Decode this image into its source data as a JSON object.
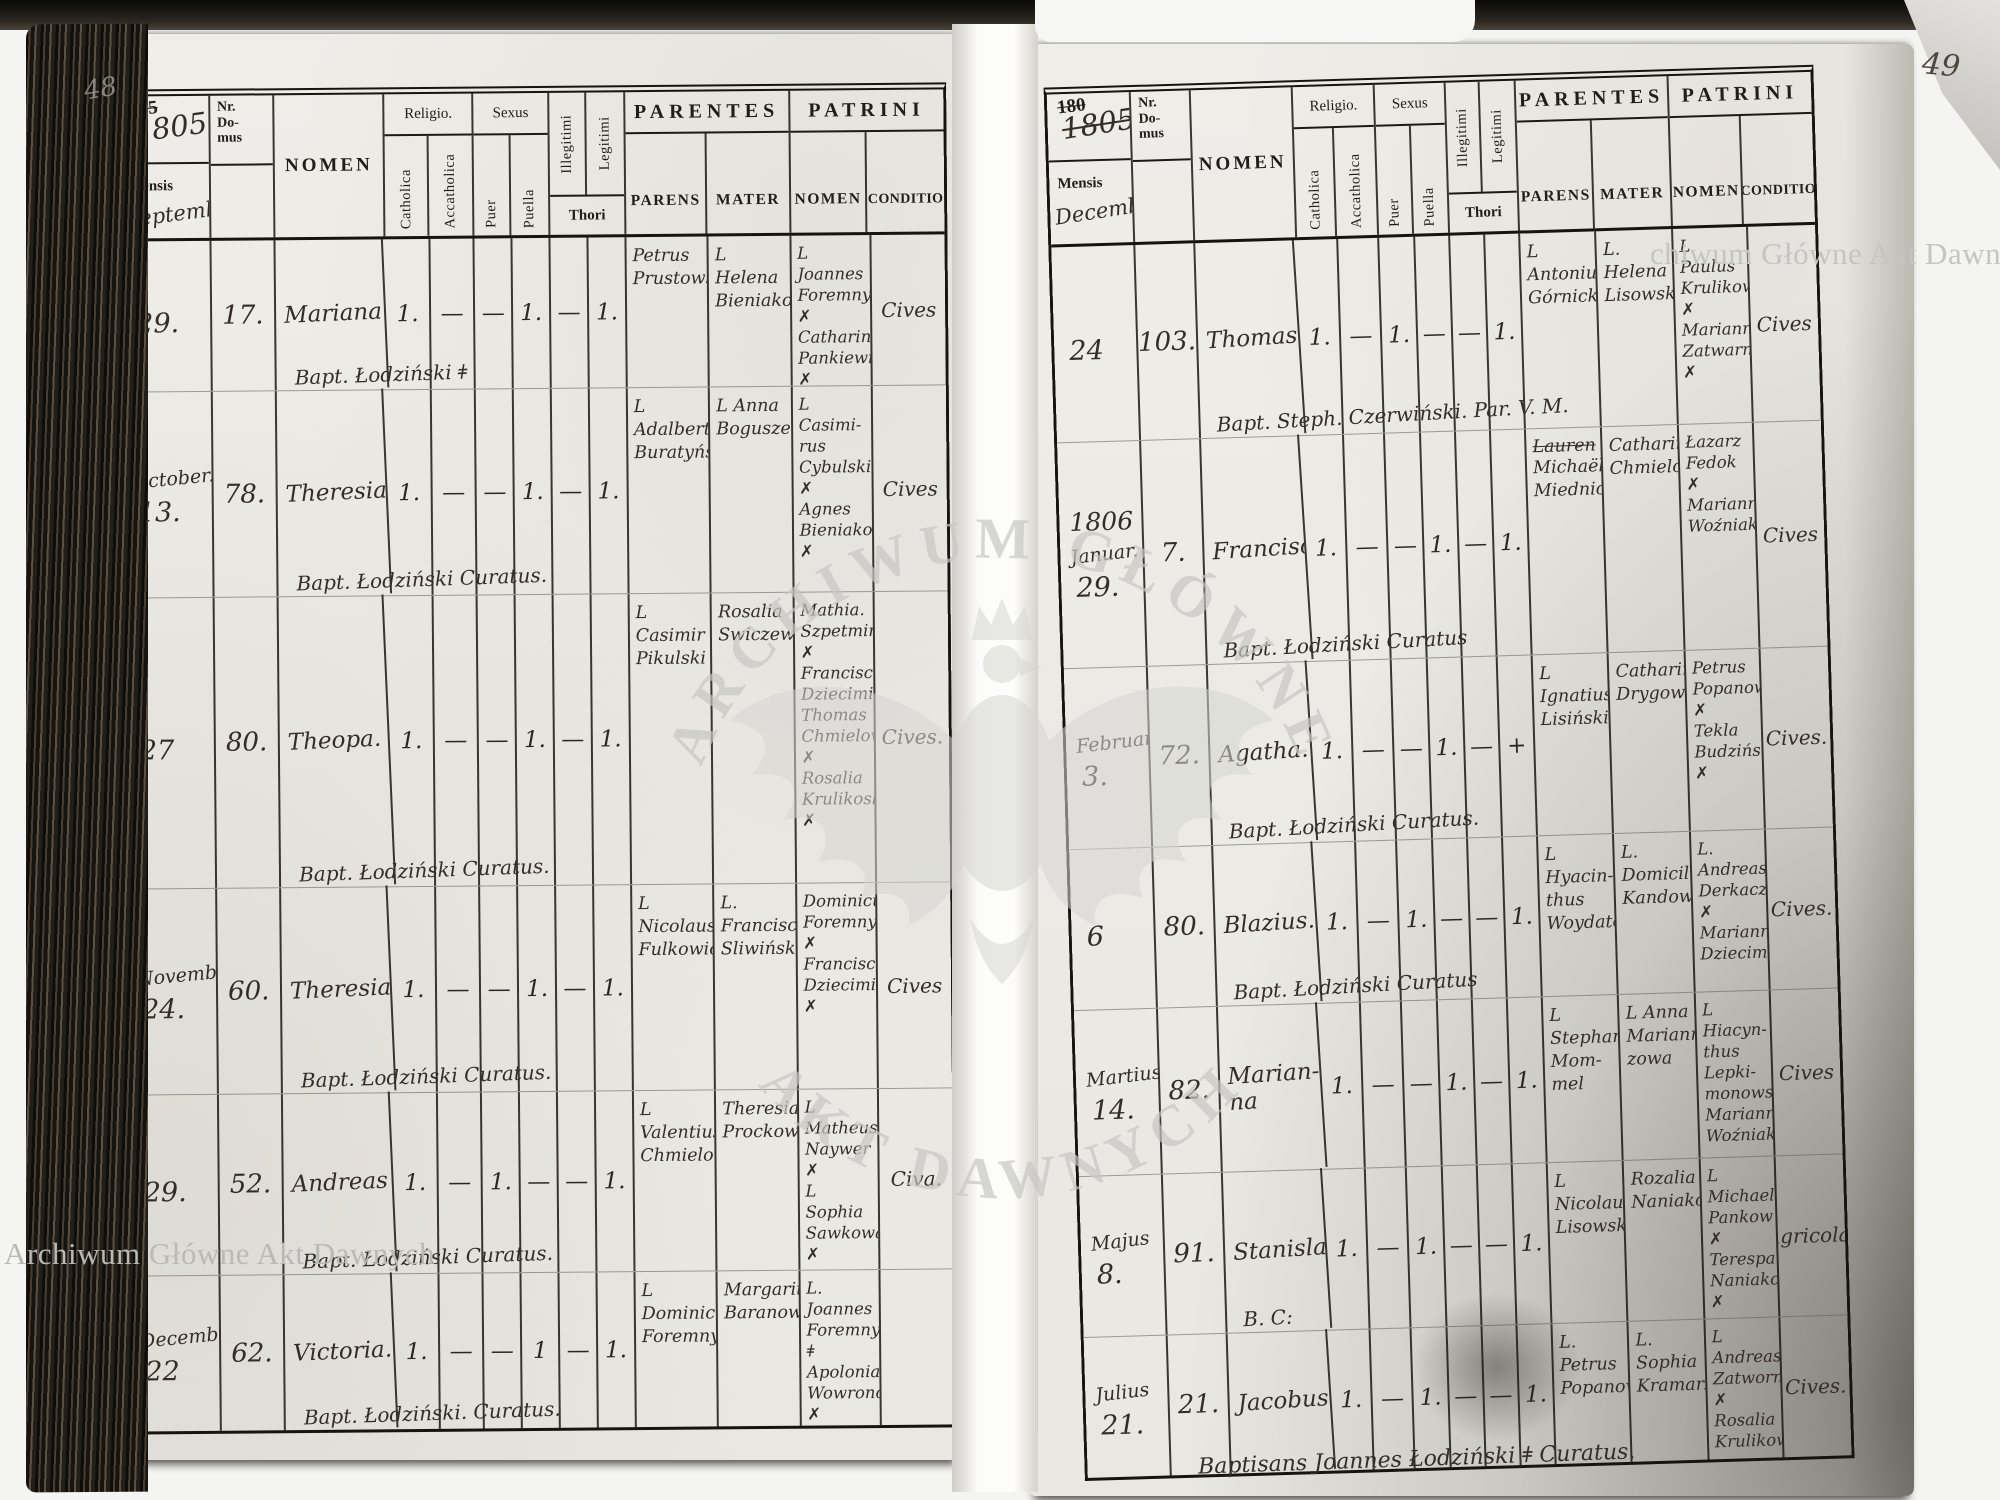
{
  "watermarks": {
    "top_right_text": "chiwum Główne Akt Dawnych",
    "bottom_left_text": "Archiwum Główne Akt Dawnych",
    "seal_top_text": "ARCHIWUM GŁÓWNE",
    "seal_bottom_text": "AKT DAWNYCH"
  },
  "headers": {
    "mensis": "Mensis",
    "nr_domus": "Nr.\nDo-\nmus",
    "nomen": "NOMEN",
    "religio": "Religio.",
    "catholica": "Catholica",
    "acatholica": "Accatholica",
    "sexus": "Sexus",
    "puer": "Puer",
    "puella": "Puella",
    "illegitimi": "Illegitimi",
    "legitimi": "Legitimi",
    "thori": "Thori",
    "parentes": "PARENTES",
    "parens": "PARENS",
    "mater": "MATER",
    "patrini": "PATRINI",
    "patrini_nomen": "NOMEN",
    "conditio": "CONDITIO"
  },
  "left_page": {
    "page_number": "48",
    "year_printed": "175",
    "year_hand": "1805",
    "month_hand": "Septemb:",
    "rows": [
      {
        "month": "",
        "day": "29.",
        "nr": "17.",
        "name": "Mariana",
        "catholica": "1.",
        "acatholica": "—",
        "puer": "—",
        "puella": "1.",
        "illegitimi": "—",
        "legitimi": "1.",
        "parens": "Petrus\nPrustowski:",
        "mater": "L Helena\nBieniakowa",
        "patrini": "L Joannes\nForemny ✗\nCatharina\nPankiewiczowa. ✗",
        "conditio": "Cives",
        "bapt": "Bapt. Łodziński ǂ"
      },
      {
        "month": "October.",
        "day": "13.",
        "nr": "78.",
        "name": "Theresia",
        "catholica": "1.",
        "acatholica": "—",
        "puer": "—",
        "puella": "1.",
        "illegitimi": "—",
        "legitimi": "1.",
        "parens": "L Adalbert\nBuratyński",
        "mater": "L Anna\nBoguszewska.",
        "patrini": "L Casimi-\nrus Cybulski ✗\nAgnes\nBieniakowa ✗",
        "conditio": "Cives",
        "bapt": "Bapt. Łodziński Curatus."
      },
      {
        "month": "",
        "day": "27",
        "nr": "80.",
        "name": "Theopa.",
        "catholica": "1.",
        "acatholica": "—",
        "puer": "—",
        "puella": "1.",
        "illegitimi": "—",
        "legitimi": "1.",
        "parens": "L Casimir\nPikulski",
        "mater": "Rosalia\nSwiczewska.",
        "patrini": "Mathia.\nSzpetmiński ✗\nFrancisca\nDziecimiakowa\nThomas\nChmielow ✗\nRosalia\nKrulikoska ✗",
        "conditio": "Cives.",
        "bapt": "Bapt. Łodziński Curatus."
      },
      {
        "month": "November",
        "day": "24.",
        "nr": "60.",
        "name": "Theresia",
        "catholica": "1.",
        "acatholica": "—",
        "puer": "—",
        "puella": "1.",
        "illegitimi": "—",
        "legitimi": "1.",
        "parens": "L Nicolaus\nFulkowicz",
        "mater": "L. Francisca\nSliwińska.",
        "patrini": "Dominicus\nForemny ✗\nFrancisca\nDziecimiakowa ✗",
        "conditio": "Cives",
        "bapt": "Bapt. Łodziński Curatus."
      },
      {
        "month": "",
        "day": "29.",
        "nr": "52.",
        "name": "Andreas",
        "catholica": "1.",
        "acatholica": "—",
        "puer": "1.",
        "puella": "—",
        "illegitimi": "—",
        "legitimi": "1.",
        "parens": "L Valentius\nChmielowski",
        "mater": "Theresia\nProckowa",
        "patrini": "L Matheus\nNaywer ✗\nL Sophia\nSawkowa ✗",
        "conditio": "Civa.",
        "bapt": "Bapt. Łodziński Curatus."
      },
      {
        "month": "December",
        "day": "22",
        "nr": "62.",
        "name": "Victoria.",
        "catholica": "1.",
        "acatholica": "—",
        "puer": "—",
        "puella": "1",
        "illegitimi": "—",
        "legitimi": "1.",
        "parens": "L Dominicus\nForemny",
        "mater": "Margaritha\nBaranowa.",
        "patrini": "L. Joannes\nForemny ǂ\nApolonia\nWowronowa ✗",
        "conditio": "",
        "bapt": "Bapt. Łodziński. Curatus."
      }
    ]
  },
  "right_page": {
    "page_number": "49",
    "year_printed": "180",
    "year_hand": "1805",
    "month_hand": "December",
    "footer": "Baptisans Joannes Łodziński ǂ Curatus.",
    "rows": [
      {
        "month": "",
        "day": "24",
        "nr": "103.",
        "name": "Thomas.",
        "catholica": "1.",
        "acatholica": "—",
        "puer": "1.",
        "puella": "—",
        "illegitimi": "—",
        "legitimi": "1.",
        "parens": "L Antonius\nGórnicki",
        "mater": "L. Helena\nLisowska",
        "patrini": "L Paulus\nKrulikowski ✗\nMarianna\nZatwarnicka ✗",
        "conditio": "Cives",
        "bapt": "Bapt. Steph. Czerwiński. Par. V. M."
      },
      {
        "year_note": "1806",
        "month": "Januar.",
        "day": "29.",
        "nr": "7.",
        "name": "Francisca",
        "catholica": "1.",
        "acatholica": "—",
        "puer": "—",
        "puella": "1.",
        "illegitimi": "—",
        "legitimi": "1.",
        "struck": "Lauren",
        "parens": "Michaël\nMiednicek.",
        "mater": "Catharina\nChmielowska",
        "patrini": "Łazarz\nFedok ✗\nMarianna\nWoźniakka.",
        "conditio": "Cives",
        "bapt": "Bapt. Łodziński Curatus"
      },
      {
        "month": "Februar",
        "day": "3.",
        "nr": "72.",
        "name": "Agatha.",
        "catholica": "1.",
        "acatholica": "—",
        "puer": "—",
        "puella": "1.",
        "illegitimi": "—",
        "legitimi": "+",
        "parens": "L Ignatius\nLisiński",
        "mater": "Catharina\nDrygowa",
        "patrini": "Petrus\nPopanowicz ✗\nTekla\nBudzińska ✗",
        "conditio": "Cives.",
        "bapt": "Bapt. Łodziński Curatus."
      },
      {
        "month": "",
        "day": "6",
        "nr": "80.",
        "name": "Blazius.",
        "catholica": "1.",
        "acatholica": "—",
        "puer": "1.",
        "puella": "—",
        "illegitimi": "—",
        "legitimi": "1.",
        "parens": "L Hyacin-\nthus\nWoydatowicz",
        "mater": "L. Domicilla\nKandowa",
        "patrini": "L. Andreas\nDerkacz ✗\nMarianna\nDziecimiakowa",
        "conditio": "Cives.",
        "bapt": "Bapt. Łodziński Curatus"
      },
      {
        "month": "Martius",
        "day": "14.",
        "nr": "82.",
        "name": "Marian-\nna",
        "catholica": "1.",
        "acatholica": "—",
        "puer": "—",
        "puella": "1.",
        "illegitimi": "—",
        "legitimi": "1.",
        "parens": "L Stephan\nMom-\nmel",
        "mater": "L Anna\nMariannow-\nzowa",
        "patrini": "L Hiacyn-\nthus Lepki-\nmonowski\nMarianna\nWoźniakowa",
        "conditio": "Cives",
        "bapt": ""
      },
      {
        "month": "Majus",
        "day": "8.",
        "nr": "91.",
        "name": "Stanislaus",
        "catholica": "1.",
        "acatholica": "—",
        "puer": "1.",
        "puella": "—",
        "illegitimi": "—",
        "legitimi": "1.",
        "parens": "L Nicolaus\nLisowski.",
        "mater": "Rozalia\nNaniakowa.",
        "patrini": "L Michael\nPankow ✗\nTerespa\nNaniakowa ✗",
        "conditio": "Agricola.",
        "bapt": "B. C:"
      },
      {
        "month": "Julius",
        "day": "21.",
        "nr": "21.",
        "name": "Jacobus",
        "catholica": "1.",
        "acatholica": "—",
        "puer": "1.",
        "puella": "—",
        "illegitimi": "—",
        "legitimi": "1.",
        "parens": "L. Petrus\nPopanowicz",
        "mater": "L. Sophia\nKramarzowa",
        "patrini": "L Andreas\nZatwornicki ✗\nRosalia\nKrulikowska",
        "conditio": "Cives.",
        "bapt": ""
      }
    ]
  }
}
